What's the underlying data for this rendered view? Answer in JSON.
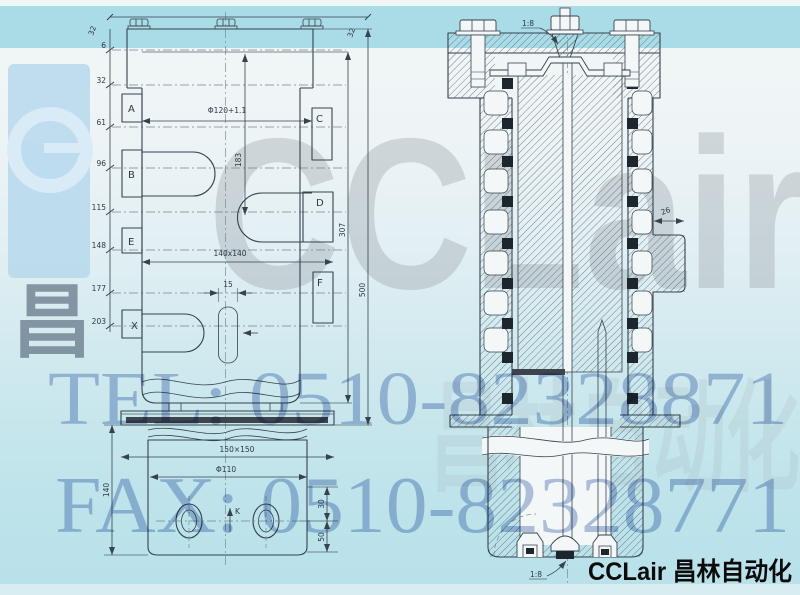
{
  "branding": {
    "watermark_logo": "CCLair",
    "watermark_cn": "昌林自动化",
    "tel_line": "TEL: 0510-82328871",
    "fax_line": "FAX: 0510-82328771",
    "footer_logo": "CCLair 昌林自动化"
  },
  "front_view": {
    "top_dim_left": "32",
    "top_dim_right": "32",
    "left_dims": [
      "6",
      "32",
      "61",
      "96",
      "115",
      "148",
      "177",
      "203"
    ],
    "ports": {
      "a": "A",
      "b": "B",
      "c": "C",
      "d": "D",
      "e": "E",
      "f": "F",
      "x": "X"
    },
    "dim_bore": "Φ120+1.1",
    "dim_183": "183",
    "dim_square": "140x140",
    "dim_slot": "15",
    "dim_307": "307",
    "dim_500": "500"
  },
  "bottom_view": {
    "dim_plate": "150×150",
    "dim_bore": "Φ110",
    "dim_height": "140",
    "dim_30": "30",
    "dim_50": "50",
    "label_k": "K"
  },
  "section_view": {
    "taper_top": "1:8",
    "taper_bottom": "1:8",
    "dim_26": "26"
  }
}
